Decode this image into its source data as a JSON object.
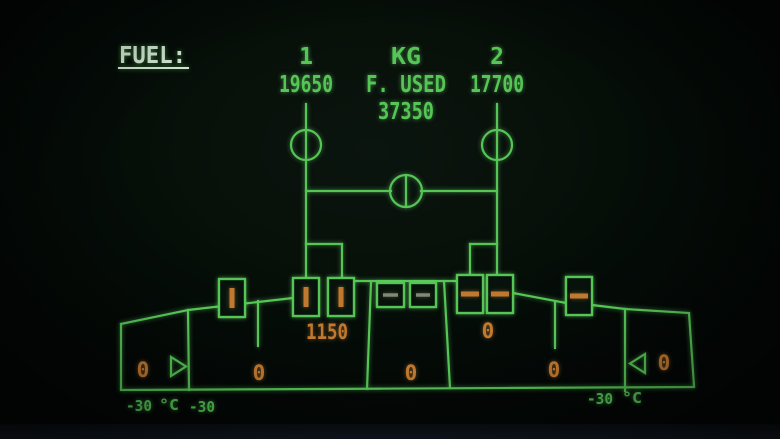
{
  "header": {
    "title": "FUEL:",
    "engine1_label": "1",
    "engine1_fob": "19650",
    "units": "KG",
    "fuel_used_label": "F. USED",
    "fuel_used_total": "37350",
    "engine2_label": "2",
    "engine2_fob": "17700"
  },
  "quantities": {
    "left_outer": "0",
    "left_inner": "0",
    "left_collector": "1150",
    "center": "0",
    "right_collector": "0",
    "right_inner": "0",
    "right_outer": "0"
  },
  "temperatures": {
    "left_outer_temp": "-30",
    "left_unit": "°C",
    "left_inner_temp": "-30",
    "right_inner_temp": "-30",
    "right_unit": "°C"
  },
  "symbols": {
    "engine1_lp_valve": "open-inline",
    "engine2_lp_valve": "open-inline",
    "crossfeed_valve": "closed-crossline",
    "pumps": [
      {
        "name": "left-outer-pump",
        "indication": "amber-vertical-bar"
      },
      {
        "name": "left-inner-pump-1",
        "indication": "amber-vertical-bar"
      },
      {
        "name": "left-inner-pump-2",
        "indication": "amber-vertical-bar"
      },
      {
        "name": "center-tank-pump-1",
        "indication": "grey-dash"
      },
      {
        "name": "center-tank-pump-2",
        "indication": "grey-dash"
      },
      {
        "name": "right-inner-pump-1",
        "indication": "amber-horizontal-bar"
      },
      {
        "name": "right-inner-pump-2",
        "indication": "amber-horizontal-bar"
      },
      {
        "name": "right-outer-pump",
        "indication": "amber-horizontal-bar"
      }
    ],
    "left_transfer_valve": "triangle-right",
    "right_transfer_valve": "triangle-left"
  },
  "colors": {
    "green": "#55C556",
    "amber": "#C1792F",
    "title": "#D7ECD7",
    "grey": "#93A295",
    "bg": "#040906"
  }
}
